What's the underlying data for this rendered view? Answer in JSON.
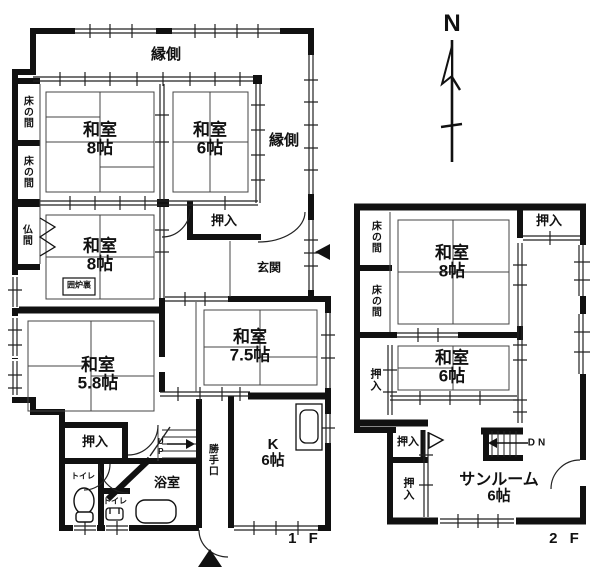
{
  "colors": {
    "wall": "#111111",
    "thin_line": "#2b2b2b",
    "background": "#ffffff"
  },
  "compass": {
    "north_label": "N"
  },
  "f1": {
    "floor_label": "1 F",
    "engawa_top": "縁側",
    "engawa_right": "縁側",
    "tokonoma_1": "床の間",
    "tokonoma_2": "床の間",
    "butsuma": "仏間",
    "washitsu8_top": {
      "name": "和室",
      "size": "8帖"
    },
    "washitsu6": {
      "name": "和室",
      "size": "6帖"
    },
    "washitsu8_mid": {
      "name": "和室",
      "size": "8帖"
    },
    "irori": "囲炉裏",
    "oshiire_hall": "押入",
    "genkan": "玄関",
    "washitsu75": {
      "name": "和室",
      "size": "7.5帖"
    },
    "washitsu58": {
      "name": "和室",
      "size": "5.8帖"
    },
    "oshiire_sw": "押入",
    "toilet_1": "トイレ",
    "toilet_2": "トイレ",
    "bath": "浴室",
    "katteguchi": "勝手口",
    "kitchen": {
      "name": "K",
      "size": "6帖"
    },
    "stairs_up": "UP"
  },
  "f2": {
    "floor_label": "2 F",
    "tokonoma_1": "床の間",
    "tokonoma_2": "床の間",
    "oshiire_ne": "押入",
    "washitsu8": {
      "name": "和室",
      "size": "8帖"
    },
    "washitsu6": {
      "name": "和室",
      "size": "6帖"
    },
    "oshiire_w": "押入",
    "oshiire_mid": "押入",
    "oshiire_sw": "押入",
    "sunroom": {
      "name": "サンルーム",
      "size": "6帖"
    },
    "stairs_down": "DN"
  }
}
